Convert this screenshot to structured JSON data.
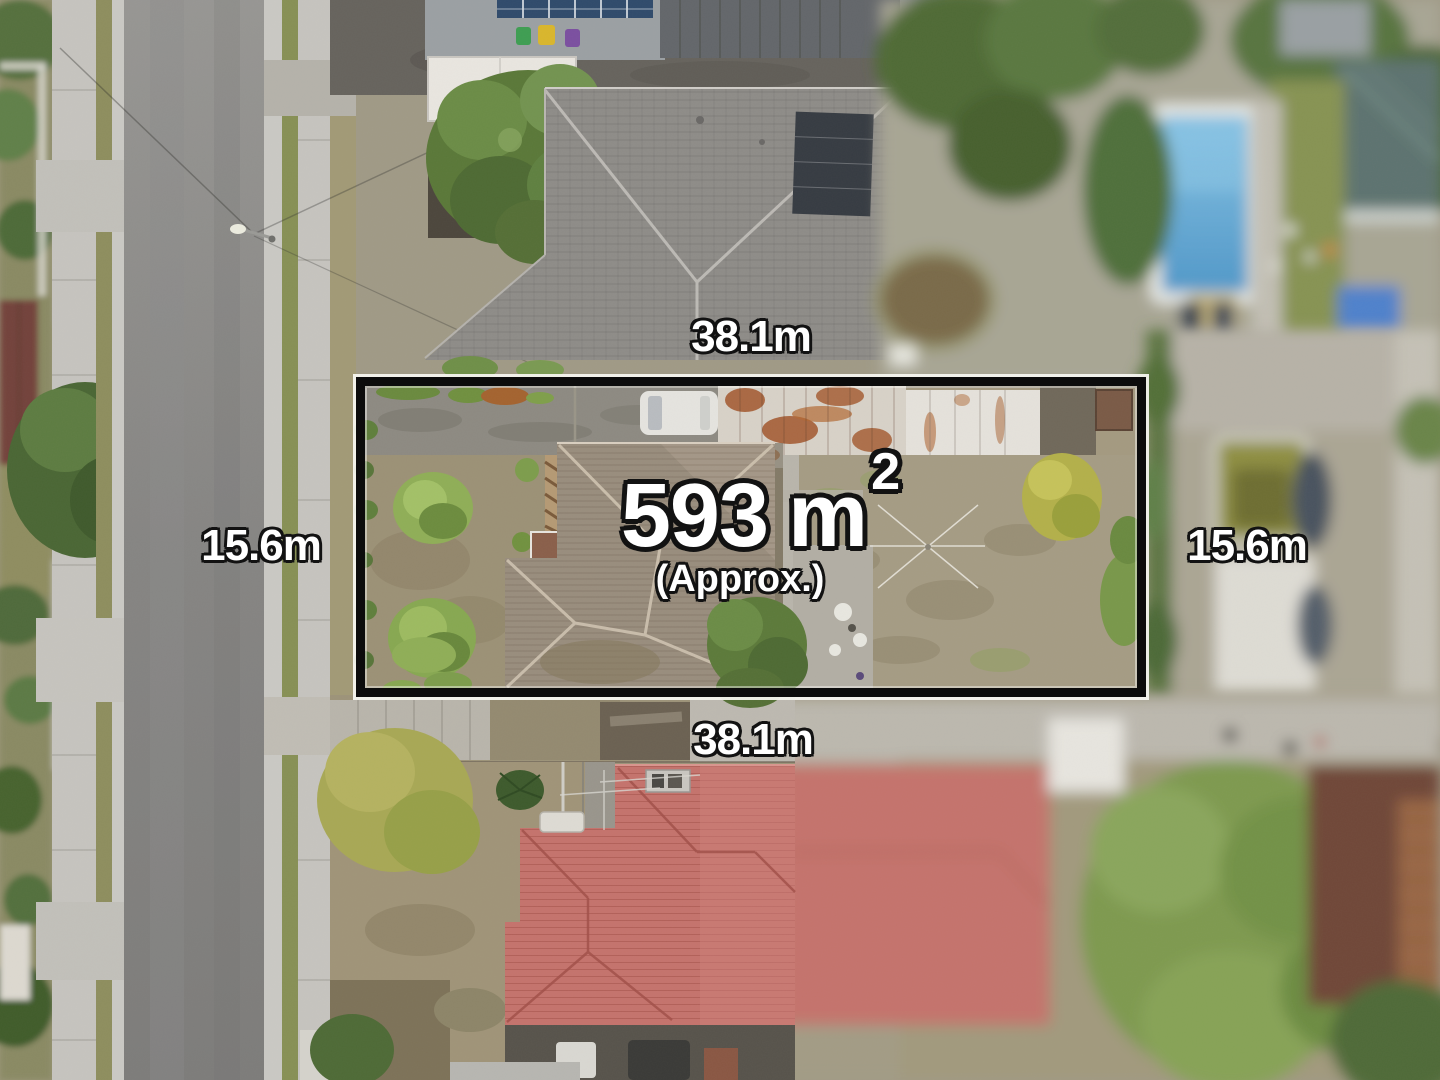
{
  "scene": {
    "description": "Aerial drone photograph of a suburban residential block outlined for sale"
  },
  "annotations": {
    "area_value": "593",
    "area_unit": "m",
    "area_exponent": "2",
    "area_qualifier": "(Approx.)",
    "dimension_top": "38.1m",
    "dimension_bottom": "38.1m",
    "dimension_left": "15.6m",
    "dimension_right": "15.6m"
  },
  "colors": {
    "boundary_stroke": "#0c0c0c",
    "boundary_outline": "#f6f5f0",
    "label_text": "#ffffff",
    "label_outline": "#121212"
  }
}
